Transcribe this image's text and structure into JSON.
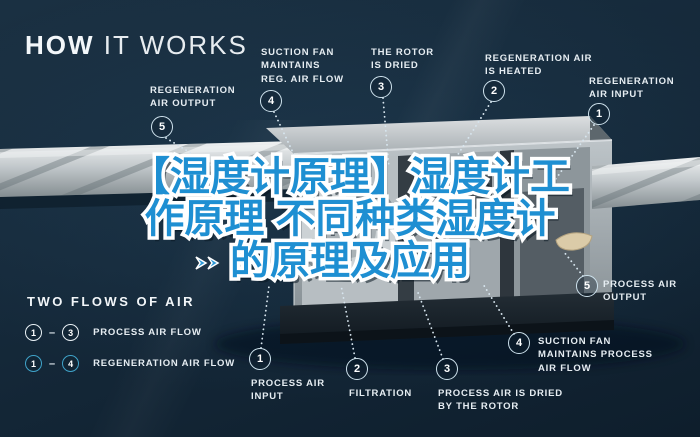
{
  "title": {
    "word_bold": "HOW",
    "word_light": " IT WORKS"
  },
  "headline": {
    "line1": "【湿度计原理】湿度计工",
    "line2": "作原理 不同种类湿度计",
    "line3": "的原理及应用",
    "text_color": "#1e8fd2",
    "outline_color": "#ffffff"
  },
  "callouts": {
    "top": [
      {
        "num": "5",
        "label": "REGENERATION\nAIR OUTPUT"
      },
      {
        "num": "4",
        "label": "SUCTION FAN\nMAINTAINS\nREG. AIR FLOW"
      },
      {
        "num": "3",
        "label": "THE ROTOR\nIS DRIED"
      },
      {
        "num": "2",
        "label": "REGENERATION AIR\nIS HEATED"
      },
      {
        "num": "1",
        "label": "REGENERATION\nAIR INPUT"
      }
    ],
    "bottom": [
      {
        "num": "1",
        "label": "PROCESS AIR\nINPUT"
      },
      {
        "num": "2",
        "label": "FILTRATION"
      },
      {
        "num": "3",
        "label": "PROCESS AIR IS DRIED\nBY THE ROTOR"
      },
      {
        "num": "4",
        "label": "SUCTION FAN\nMAINTAINS PROCESS\nAIR FLOW"
      },
      {
        "num": "5",
        "label": "PROCESS AIR\nOUTPUT"
      }
    ]
  },
  "legend": {
    "heading": "TWO FLOWS OF AIR",
    "rows": [
      {
        "from": "1",
        "to": "3",
        "separator": "–",
        "label": "PROCESS AIR FLOW",
        "ring_color": "#e9f1f5"
      },
      {
        "from": "1",
        "to": "4",
        "separator": "–",
        "label": "REGENERATION AIR FLOW",
        "ring_color": "#3fa3c9"
      }
    ]
  },
  "colors": {
    "background": "#15293a",
    "label_text": "#e6edf2",
    "leader_dots": "#d7e5ee",
    "machine_gray": "#aeb6ba",
    "duct_gray": "#c3c9cc",
    "headline_blue": "#1e8fd2",
    "badge_ring": "#cfe3ee"
  }
}
